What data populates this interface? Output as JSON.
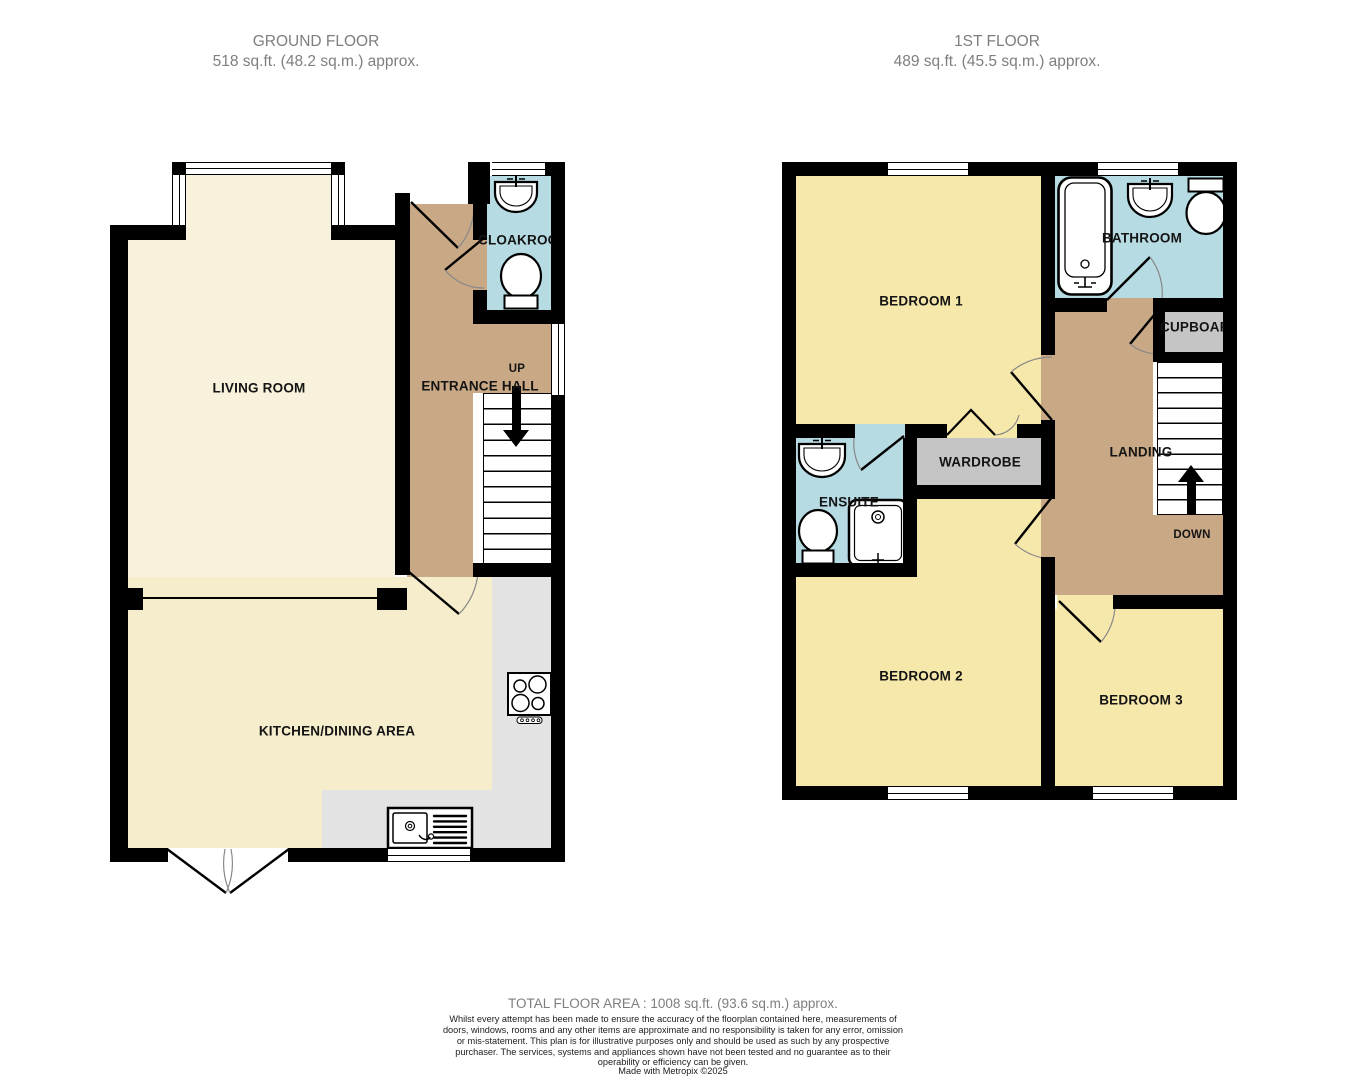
{
  "ground_floor": {
    "title": "GROUND FLOOR",
    "subtitle": "518 sq.ft. (48.2 sq.m.) approx.",
    "rooms": {
      "living_room": "LIVING ROOM",
      "entrance_hall": "ENTRANCE HALL",
      "cloakroom": "CLOAKROOM",
      "kitchen_dining": "KITCHEN/DINING AREA",
      "up": "UP"
    }
  },
  "first_floor": {
    "title": "1ST FLOOR",
    "subtitle": "489 sq.ft. (45.5 sq.m.) approx.",
    "rooms": {
      "bedroom1": "BEDROOM 1",
      "bathroom": "BATHROOM",
      "cupboard": "CUPBOARD",
      "landing": "LANDING",
      "wardrobe": "WARDROBE",
      "ensuite": "ENSUITE",
      "bedroom2": "BEDROOM 2",
      "bedroom3": "BEDROOM 3",
      "down": "DOWN"
    }
  },
  "footer": {
    "total_area": "TOTAL FLOOR AREA : 1008 sq.ft. (93.6 sq.m.) approx.",
    "disclaimer": "Whilst every attempt has been made to ensure the accuracy of the floorplan contained here, measurements of doors, windows, rooms and any other items are approximate and no responsibility is taken for any error, omission or mis-statement. This plan is for illustrative purposes only and should be used as such by any prospective purchaser. The services, systems and appliances shown have not been tested and no guarantee as to their operability or efficiency can be given.",
    "credit": "Made with Metropix ©2025"
  },
  "fixtures": {
    "cloakroom": [
      "sink-icon",
      "toilet-icon"
    ],
    "kitchen": [
      "stove-icon",
      "kitchen-sink-icon"
    ],
    "bathroom": [
      "bathtub-icon",
      "sink-icon",
      "toilet-icon"
    ],
    "ensuite": [
      "sink-icon",
      "toilet-icon",
      "shower-icon"
    ],
    "stairs": [
      "up-arrow-icon",
      "down-arrow-icon"
    ]
  },
  "colors": {
    "wall": "#000000",
    "cream": "#F8F2DC",
    "kcream": "#F5EDCC",
    "tan": "#C9A885",
    "blue": "#B6DBE2",
    "gray": "#C5C5C5",
    "counter": "#E3E3E3",
    "yellow": "#F6E7AB",
    "title": "#7E7E7E"
  }
}
